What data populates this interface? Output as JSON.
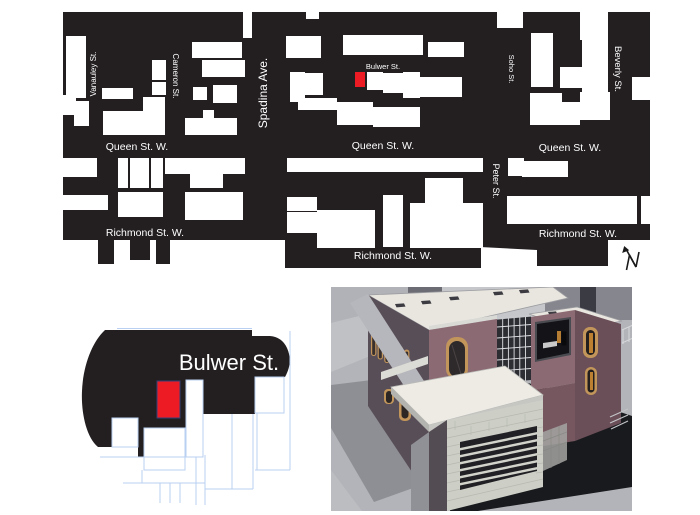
{
  "site_map": {
    "labels": [
      {
        "id": "queen-west-left",
        "text": "Queen St. W."
      },
      {
        "id": "queen-west-mid",
        "text": "Queen St. W."
      },
      {
        "id": "queen-west-right",
        "text": "Queen St. W."
      },
      {
        "id": "richmond-left",
        "text": "Richmond St. W."
      },
      {
        "id": "richmond-mid",
        "text": "Richmond St. W."
      },
      {
        "id": "richmond-right",
        "text": "Richmond St. W."
      },
      {
        "id": "vanauley",
        "text": "Vanauley St."
      },
      {
        "id": "cameron",
        "text": "Cameron St."
      },
      {
        "id": "spadina",
        "text": "Spadina Ave."
      },
      {
        "id": "soho",
        "text": "Soho St."
      },
      {
        "id": "peter",
        "text": "Peter St."
      },
      {
        "id": "beverly",
        "text": "Beverly St."
      },
      {
        "id": "bulwer",
        "text": "Bulwer St."
      }
    ],
    "north_arrow_label": "N",
    "colors": {
      "block_fill": "#231f20",
      "building_fill": "#ffffff",
      "site_highlight": "#ed1c24"
    }
  },
  "detail_map": {
    "label": "Bulwer St.",
    "colors": {
      "block_fill": "#231f20",
      "site_highlight": "#ed1c24",
      "site_outline": "#33417a",
      "parcel_line": "#b9d0f2"
    }
  },
  "render_3d": {
    "colors": {
      "brick_lit": "#8c6a73",
      "brick_shaded": "#584e57",
      "roof": "#e9e6e0",
      "stone": "#cdcfc7",
      "window_frame": "#c2955b",
      "glass": "#2b2d33",
      "shadow": "#191a1e",
      "ground": "#b3b4b9"
    }
  }
}
